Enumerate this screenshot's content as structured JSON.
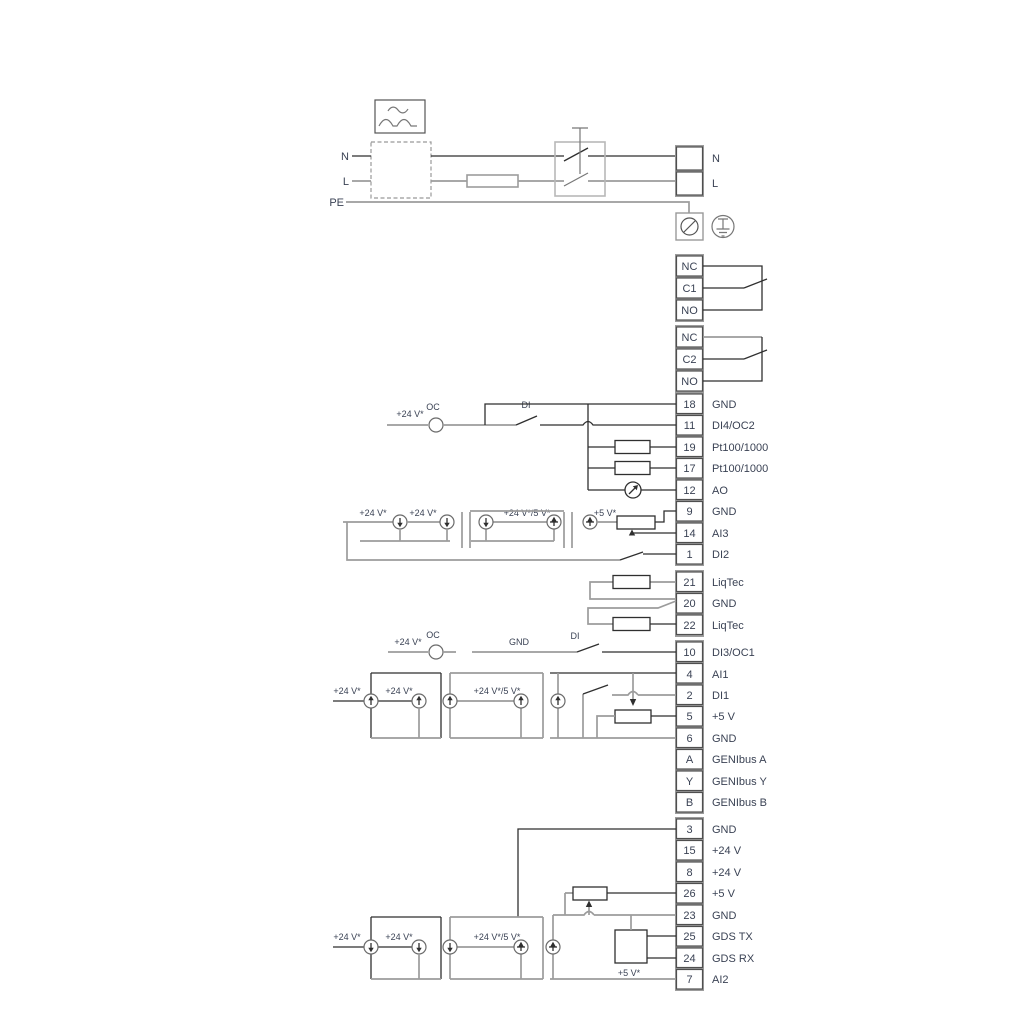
{
  "power": {
    "n": "N",
    "l": "L",
    "pe": "PE",
    "term_n": "N",
    "term_l": "L"
  },
  "relay1": {
    "t0": "NC",
    "t1": "C1",
    "t2": "NO"
  },
  "relay2": {
    "t0": "NC",
    "t1": "C2",
    "t2": "NO"
  },
  "t1": [
    {
      "n": "18",
      "l": "GND"
    },
    {
      "n": "11",
      "l": "DI4/OC2"
    },
    {
      "n": "19",
      "l": "Pt100/1000"
    },
    {
      "n": "17",
      "l": "Pt100/1000"
    },
    {
      "n": "12",
      "l": "AO"
    },
    {
      "n": "9",
      "l": "GND"
    },
    {
      "n": "14",
      "l": "AI3"
    },
    {
      "n": "1",
      "l": "DI2"
    }
  ],
  "t2": [
    {
      "n": "21",
      "l": "LiqTec"
    },
    {
      "n": "20",
      "l": "GND"
    },
    {
      "n": "22",
      "l": "LiqTec"
    }
  ],
  "t3": [
    {
      "n": "10",
      "l": "DI3/OC1"
    },
    {
      "n": "4",
      "l": "AI1"
    },
    {
      "n": "2",
      "l": "DI1"
    },
    {
      "n": "5",
      "l": "+5 V"
    },
    {
      "n": "6",
      "l": "GND"
    },
    {
      "n": "A",
      "l": "GENIbus A"
    },
    {
      "n": "Y",
      "l": "GENIbus Y"
    },
    {
      "n": "B",
      "l": "GENIbus B"
    }
  ],
  "t4": [
    {
      "n": "3",
      "l": "GND"
    },
    {
      "n": "15",
      "l": "+24 V"
    },
    {
      "n": "8",
      "l": "+24 V"
    },
    {
      "n": "26",
      "l": "+5 V"
    },
    {
      "n": "23",
      "l": "GND"
    },
    {
      "n": "25",
      "l": "GDS TX"
    },
    {
      "n": "24",
      "l": "GDS RX"
    },
    {
      "n": "7",
      "l": "AI2"
    }
  ],
  "secA": {
    "v24": "+24 V*",
    "oc": "OC",
    "di": "DI"
  },
  "secB": {
    "v24a": "+24 V*",
    "v24b": "+24 V*",
    "v245": "+24 V*/5 V*",
    "v5": "+5 V*"
  },
  "secC": {
    "v24": "+24 V*",
    "oc": "OC",
    "gnd": "GND",
    "di": "DI"
  },
  "secD": {
    "v24a": "+24 V*",
    "v24b": "+24 V*",
    "v245": "+24 V*/5 V*"
  },
  "secE": {
    "v24a": "+24 V*",
    "v24b": "+24 V*",
    "v245": "+24 V*/5 V*",
    "v5": "+5 V*"
  },
  "colors": {
    "wire_black": "#2f2f2f",
    "wire_gray": "#9c9c9c",
    "text": "#3a4254",
    "cell_border": "#4f4f4f",
    "cell_separator": "#9c9c9c",
    "background": "#ffffff"
  }
}
